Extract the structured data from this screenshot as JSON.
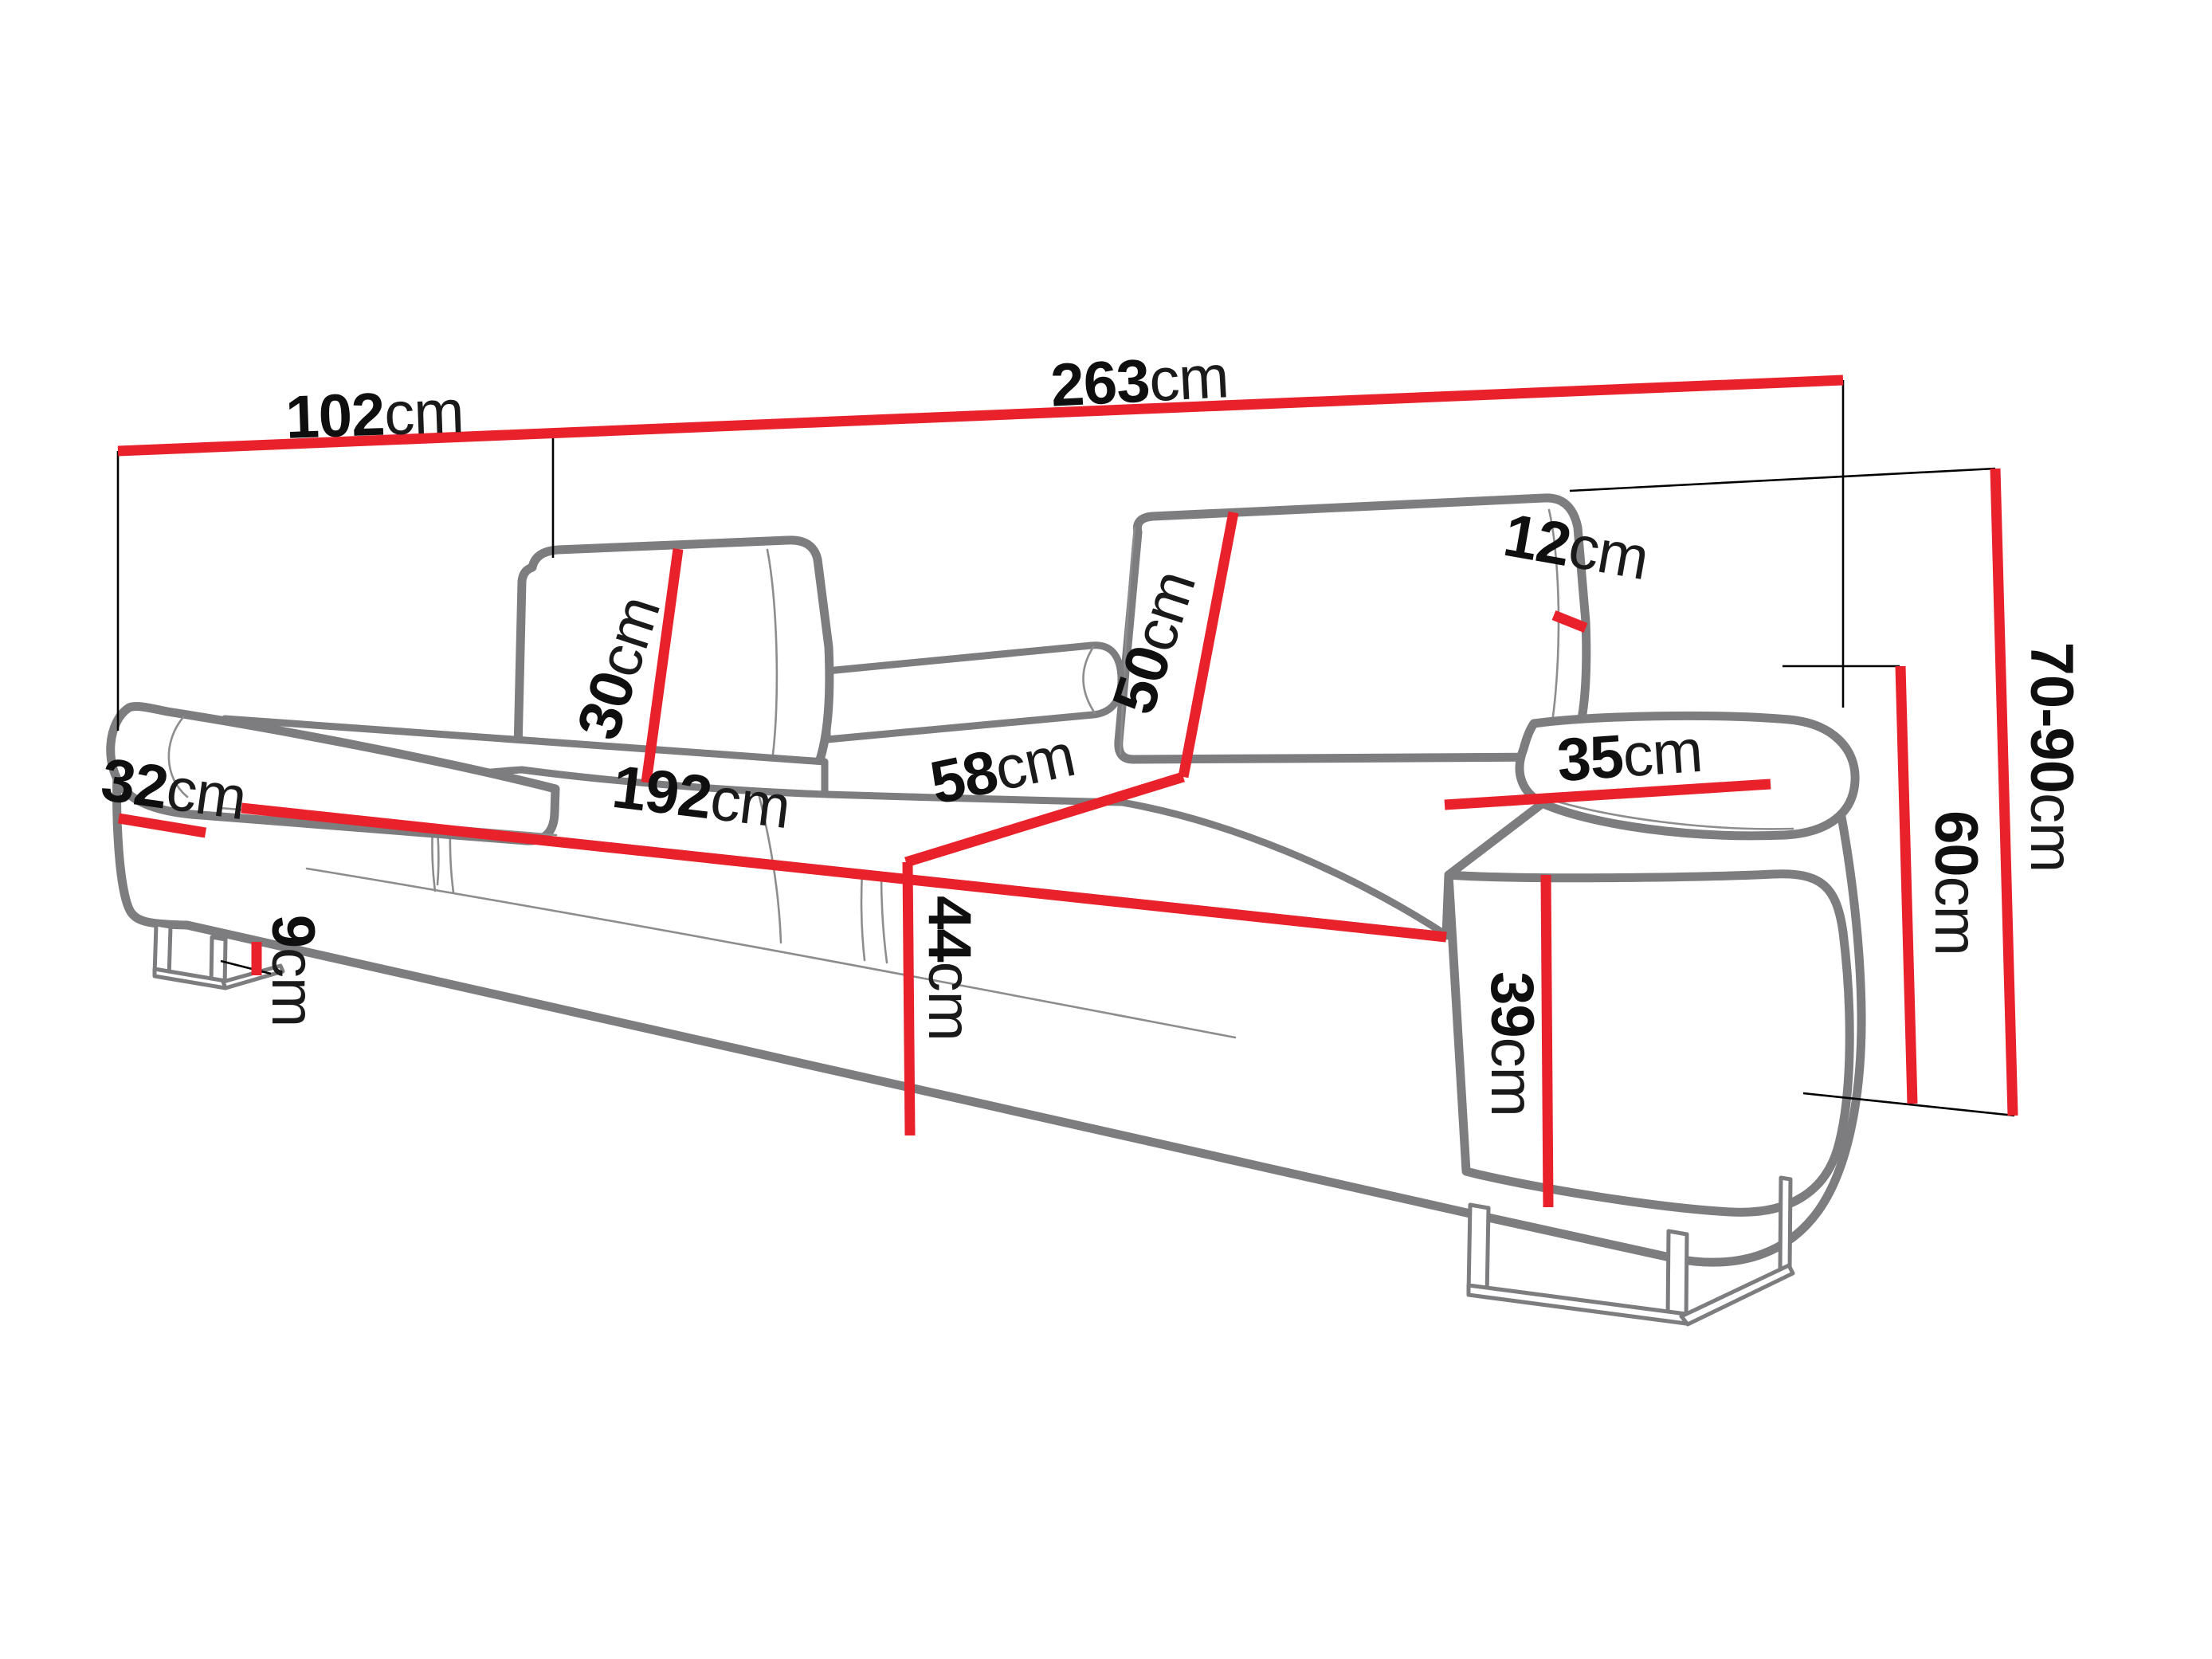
{
  "diagram": {
    "type": "furniture-dimension-diagram",
    "subject": "three-seat sofa with adjustable headrests, line drawing with red dimension lines",
    "unit": "cm",
    "colors": {
      "dimension_line": "#e8212b",
      "sofa_outline": "#7d7d7f",
      "extension_line": "#000000",
      "background": "#ffffff",
      "label_text": "#0f0f0f"
    },
    "dimensions": {
      "overall_depth": {
        "num": "102",
        "unit": "cm"
      },
      "overall_width": {
        "num": "263",
        "unit": "cm"
      },
      "headrest_height": {
        "num": "30",
        "unit": "cm"
      },
      "backrest_height": {
        "num": "50",
        "unit": "cm"
      },
      "backrest_thickness": {
        "num": "12",
        "unit": "cm"
      },
      "total_height_range": {
        "num": "70-90",
        "unit": "cm"
      },
      "armrest_width": {
        "num": "32",
        "unit": "cm"
      },
      "seat_width": {
        "num": "192",
        "unit": "cm"
      },
      "seat_depth": {
        "num": "58",
        "unit": "cm"
      },
      "armrest_pad_width": {
        "num": "35",
        "unit": "cm"
      },
      "armrest_height": {
        "num": "60",
        "unit": "cm"
      },
      "floor_clearance": {
        "num": "9",
        "unit": "cm"
      },
      "seat_height": {
        "num": "44",
        "unit": "cm"
      },
      "armrest_front_height": {
        "num": "39",
        "unit": "cm"
      }
    }
  }
}
